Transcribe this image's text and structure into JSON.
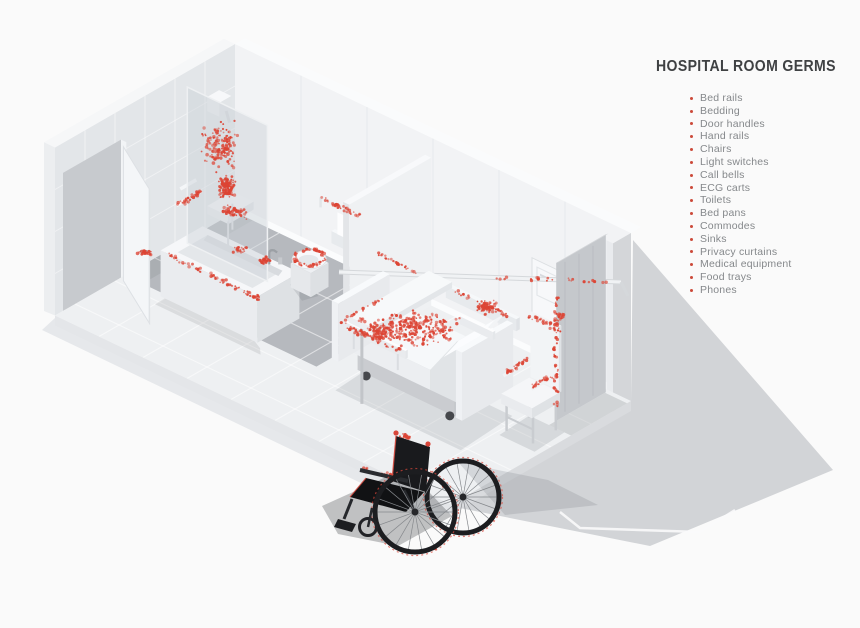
{
  "page": {
    "background": "#fafafa"
  },
  "legend": {
    "title": "HOSPITAL ROOM GERMS",
    "items": [
      "Bed rails",
      "Bedding",
      "Door handles",
      "Hand rails",
      "Chairs",
      "Light switches",
      "Call bells",
      "ECG carts",
      "Toilets",
      "Bed pans",
      "Commodes",
      "Sinks",
      "Privacy curtains",
      "Medical equipment",
      "Food trays",
      "Phones"
    ]
  },
  "monitor": {
    "heart_rate": "95",
    "blood_pressure": "120/80",
    "secondary": "11"
  },
  "colors": {
    "germ": "#dc4434",
    "bullet": "#cc4a3a",
    "title": "#3f4143",
    "legend_text": "#85888b",
    "shadow": "#d2d4d7",
    "floor": "#eef0f2",
    "bath_floor": "#b6b9be",
    "wall_nw": "#e3e6e9",
    "wall_ne": "#f2f3f5"
  },
  "germ_clusters": [
    {
      "name": "shower-wall-cloud",
      "type": "cloud",
      "iso": [
        0.45,
        0.85,
        95
      ],
      "sx": 24,
      "sy": 30,
      "n": 150,
      "seed": 11
    },
    {
      "name": "shower-seat-dense",
      "type": "cloud",
      "iso": [
        0.5,
        0.75,
        52
      ],
      "sx": 11,
      "sy": 15,
      "n": 120,
      "seed": 12
    },
    {
      "name": "shower-fall",
      "type": "cloud",
      "iso": [
        0.6,
        0.7,
        28
      ],
      "sx": 17,
      "sy": 8,
      "n": 55,
      "seed": 13
    },
    {
      "name": "shower-floor",
      "type": "cloud",
      "iso": [
        0.9,
        0.9,
        2
      ],
      "sx": 14,
      "sy": 5,
      "n": 18,
      "seed": 14
    },
    {
      "name": "shower-grab-bar",
      "type": "line",
      "iso_from": [
        0.12,
        0.95,
        45
      ],
      "iso_to": [
        0.12,
        1.6,
        45
      ],
      "jitter": 2.2,
      "n": 28,
      "seed": 15
    },
    {
      "name": "entry-door-handle",
      "type": "cloud",
      "screen": [
        144,
        253
      ],
      "sx": 8,
      "sy": 4,
      "n": 26,
      "seed": 16
    },
    {
      "name": "tub-rim",
      "type": "line",
      "iso_from": [
        1.0,
        2.87,
        46
      ],
      "iso_to": [
        3.05,
        2.87,
        46
      ],
      "jitter": 2,
      "n": 62,
      "seed": 17
    },
    {
      "name": "tub-corner",
      "type": "cloud",
      "iso": [
        3.0,
        2.8,
        42
      ],
      "sx": 6,
      "sy": 4,
      "n": 16,
      "seed": 18
    },
    {
      "name": "sink-faucet",
      "type": "cloud",
      "iso": [
        2.55,
        2.05,
        52
      ],
      "sx": 8,
      "sy": 5,
      "n": 24,
      "seed": 19
    },
    {
      "name": "toilet-seat-ring",
      "type": "ring",
      "iso": [
        2.55,
        0.95,
        30
      ],
      "rx": 15,
      "ry": 8,
      "n": 60,
      "seed": 20
    },
    {
      "name": "toilet-grab-bar",
      "type": "line",
      "iso_from": [
        2.0,
        0.06,
        58
      ],
      "iso_to": [
        2.95,
        0.06,
        58
      ],
      "jitter": 2.2,
      "n": 34,
      "seed": 21
    },
    {
      "name": "wall-rail-1",
      "type": "line",
      "iso_from": [
        3.35,
        0.09,
        30
      ],
      "iso_to": [
        4.2,
        0.09,
        30
      ],
      "jitter": 1.8,
      "n": 30,
      "seed": 22
    },
    {
      "name": "wall-rail-2",
      "type": "line",
      "iso_from": [
        5.1,
        0.09,
        30
      ],
      "iso_to": [
        6.3,
        0.09,
        30
      ],
      "jitter": 1.8,
      "n": 38,
      "seed": 23
    },
    {
      "name": "light-switch",
      "type": "cloud",
      "iso": [
        7.42,
        0.04,
        52
      ],
      "sx": 5,
      "sy": 6,
      "n": 14,
      "seed": 24
    },
    {
      "name": "bedding-cloud",
      "type": "cloud",
      "iso": [
        6.05,
        2.2,
        60
      ],
      "sx": 52,
      "sy": 23,
      "n": 260,
      "seed": 25
    },
    {
      "name": "bedding-cloud-2",
      "type": "cloud",
      "iso": [
        5.55,
        2.5,
        54
      ],
      "sx": 24,
      "sy": 11,
      "n": 80,
      "seed": 26
    },
    {
      "name": "bed-rail-se",
      "type": "line",
      "iso_from": [
        5.05,
        2.92,
        62
      ],
      "iso_to": [
        6.45,
        2.92,
        62
      ],
      "jitter": 2.6,
      "n": 48,
      "seed": 27
    },
    {
      "name": "bed-head-top",
      "type": "cloud",
      "iso": [
        7.3,
        1.75,
        98
      ],
      "sx": 18,
      "sy": 9,
      "n": 55,
      "seed": 28
    },
    {
      "name": "bed-foot-edge",
      "type": "line",
      "iso_from": [
        4.95,
        1.75,
        58
      ],
      "iso_to": [
        4.95,
        2.8,
        58
      ],
      "jitter": 1.6,
      "n": 16,
      "seed": 29
    },
    {
      "name": "table-edge",
      "type": "line",
      "iso_from": [
        5.5,
        3.05,
        80
      ],
      "iso_to": [
        5.95,
        3.05,
        80
      ],
      "jitter": 1.6,
      "n": 12,
      "seed": 30
    },
    {
      "name": "curtain-rod",
      "type": "line",
      "screen_from": [
        494,
        278
      ],
      "screen_to": [
        607,
        281
      ],
      "jitter": 1.8,
      "n": 22,
      "seed": 31
    },
    {
      "name": "curtain-edge",
      "type": "line",
      "screen_from": [
        556,
        298
      ],
      "screen_to": [
        556,
        408
      ],
      "jitter": 2.4,
      "n": 50,
      "seed": 32
    },
    {
      "name": "chair-armrest-left",
      "type": "line",
      "iso_from": [
        8.08,
        1.52,
        58
      ],
      "iso_to": [
        8.08,
        2.15,
        58
      ],
      "jitter": 2,
      "n": 22,
      "seed": 33
    },
    {
      "name": "chair-armrest-right",
      "type": "line",
      "iso_from": [
        8.72,
        1.52,
        58
      ],
      "iso_to": [
        8.72,
        2.15,
        58
      ],
      "jitter": 2,
      "n": 22,
      "seed": 34
    },
    {
      "name": "chair-back-top",
      "type": "line",
      "iso_from": [
        8.05,
        1.5,
        100
      ],
      "iso_to": [
        8.75,
        1.5,
        100
      ],
      "jitter": 2,
      "n": 24,
      "seed": 35
    },
    {
      "name": "wheelchair-handles",
      "type": "cloud",
      "screen": [
        404,
        437
      ],
      "sx": 10,
      "sy": 5,
      "n": 16,
      "seed": 36
    },
    {
      "name": "wheelchair-armrest",
      "type": "line",
      "screen_from": [
        362,
        468
      ],
      "screen_to": [
        408,
        480
      ],
      "jitter": 1.6,
      "n": 14,
      "seed": 37
    },
    {
      "name": "wheelchair-rim-left",
      "type": "ringarc",
      "screen": [
        415,
        512
      ],
      "r": 40,
      "a0": -2.4,
      "a1": 1.2,
      "n": 26,
      "seed": 38
    },
    {
      "name": "wheelchair-rim-right",
      "type": "ringarc",
      "screen": [
        463,
        497
      ],
      "r": 36,
      "a0": -2.0,
      "a1": 0.8,
      "n": 16,
      "seed": 39
    }
  ]
}
